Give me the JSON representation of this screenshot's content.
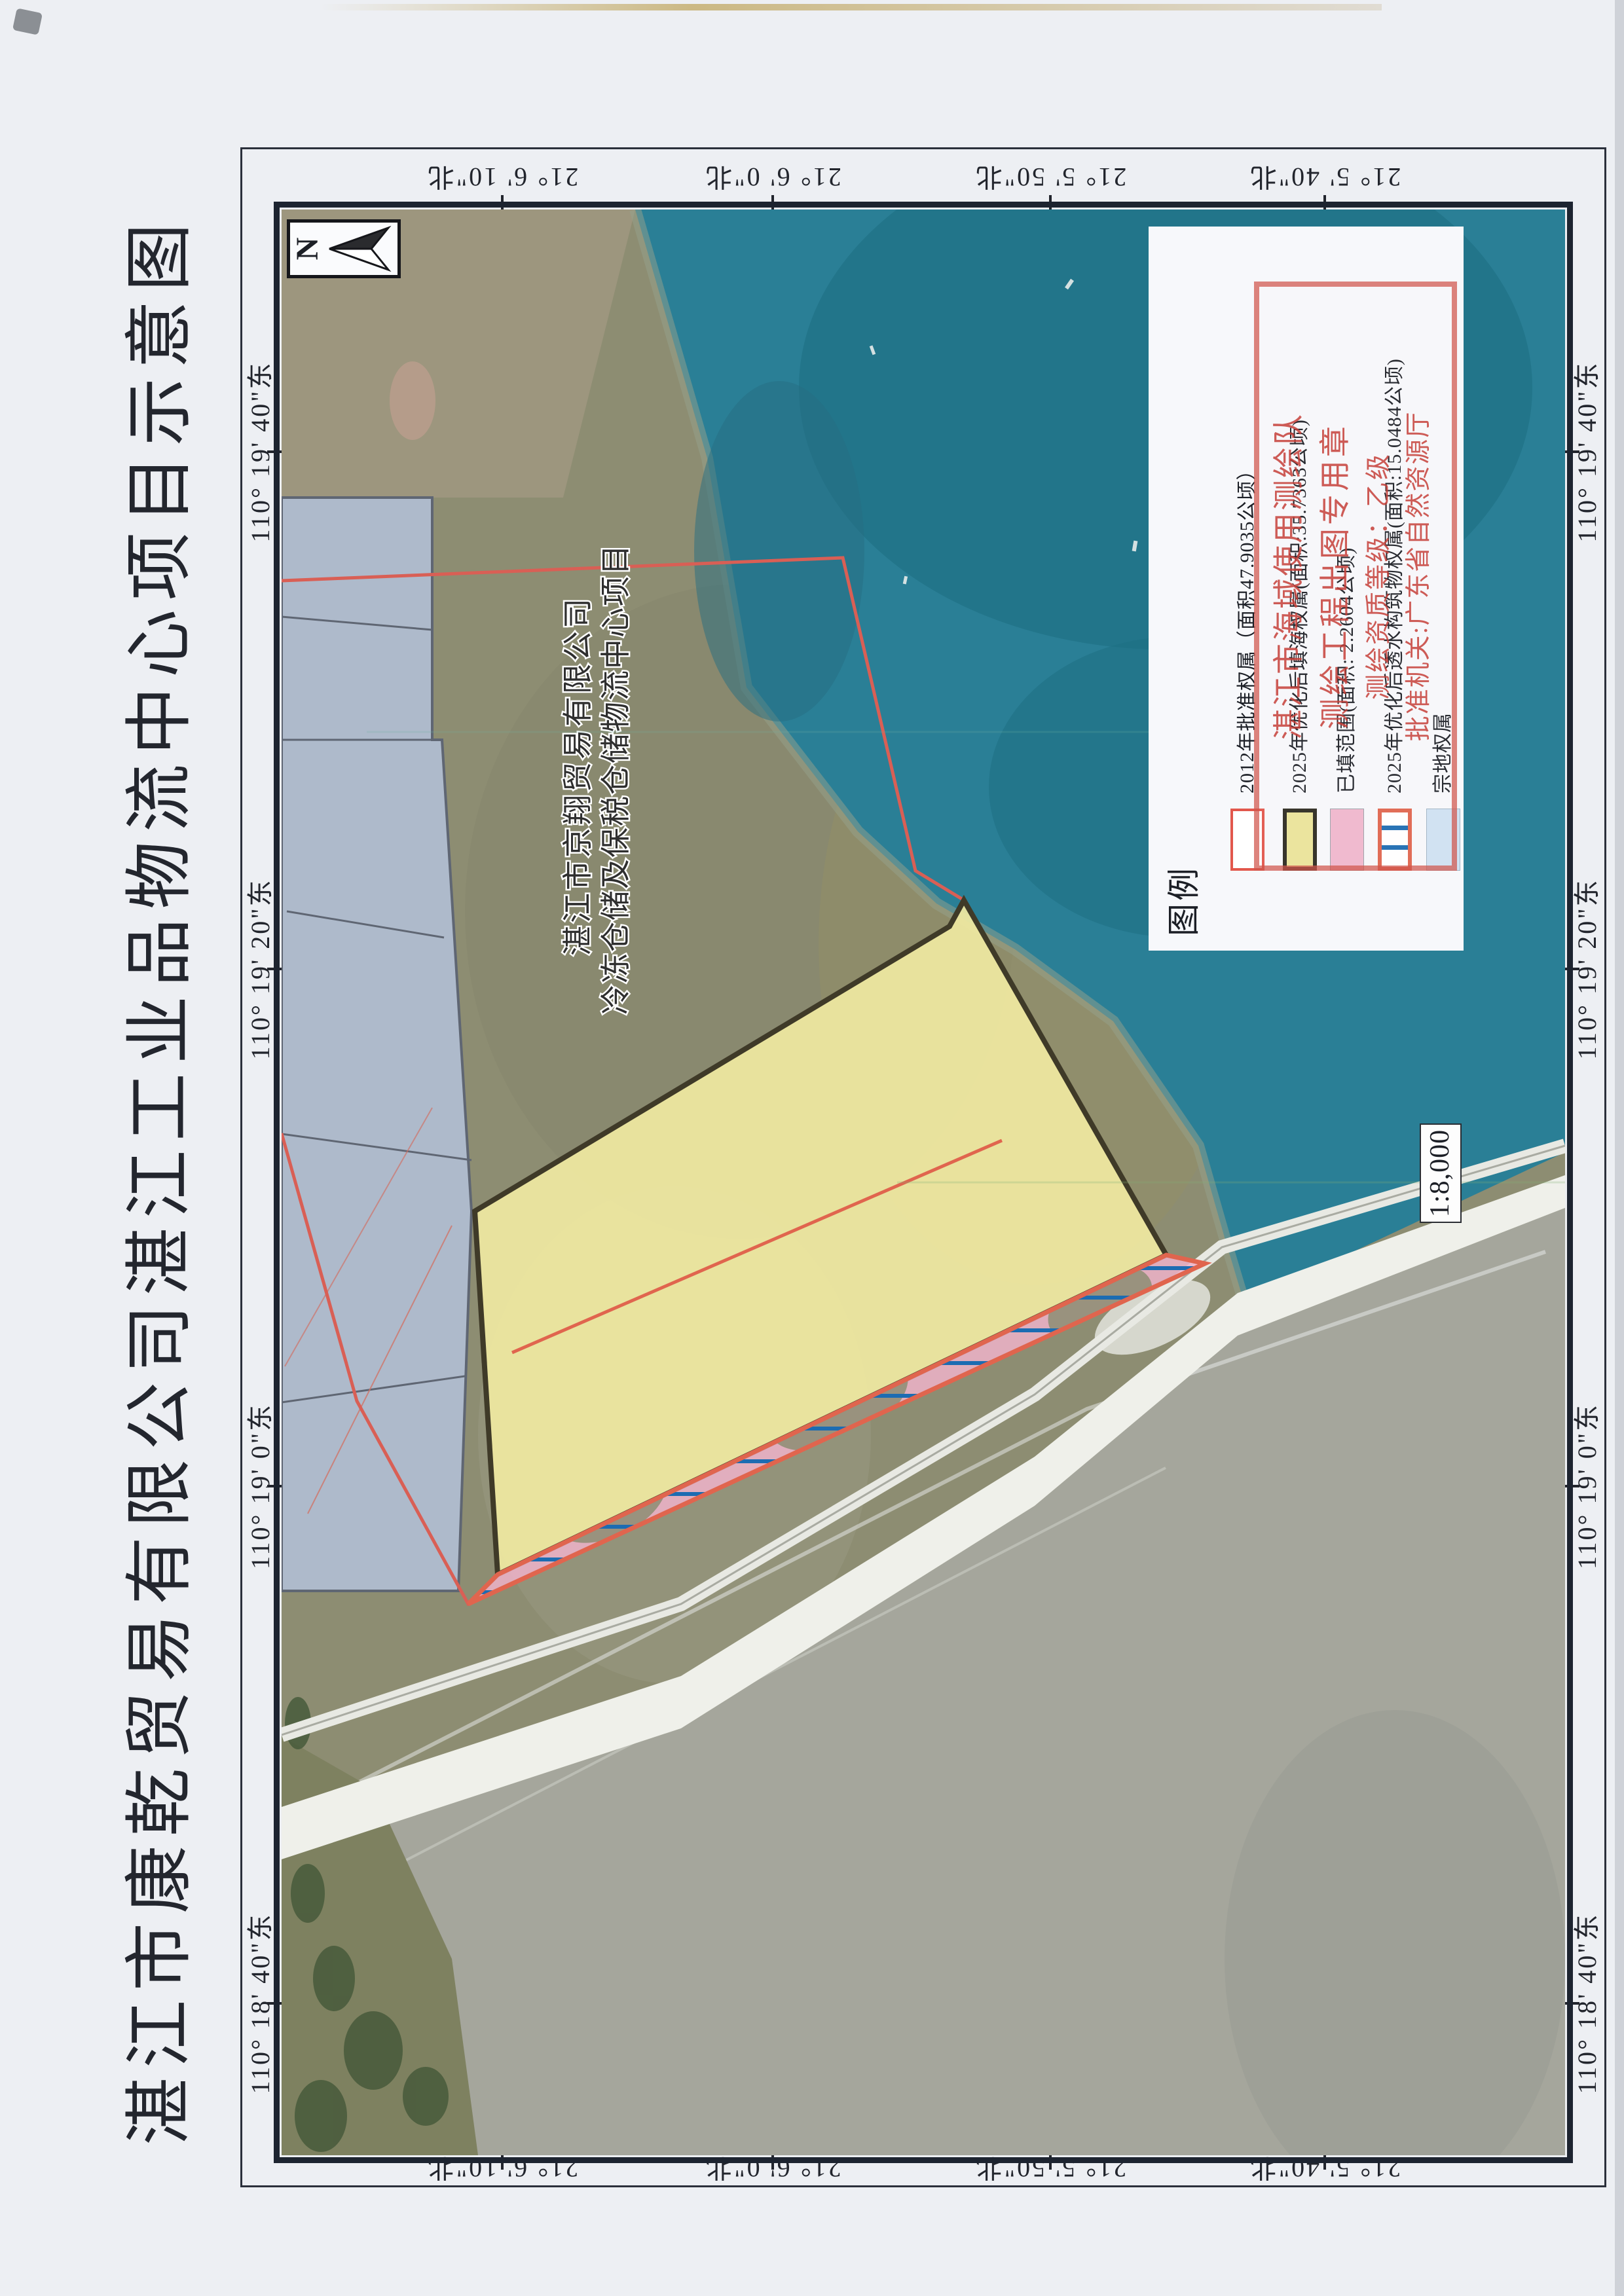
{
  "page": {
    "title": "湛江市康乾贸易有限公司湛江工业品物流中心项目示意图",
    "scale_text": "1:8,000",
    "north_label": "N"
  },
  "legend": {
    "title": "图例",
    "items": [
      {
        "key": "approved-2012",
        "label": "2012年批准权属（面积47.9035公顷）"
      },
      {
        "key": "reclaim-2025",
        "label": "2025年优化后填海权属(面积:35.7363公顷)"
      },
      {
        "key": "filled-range",
        "label": "已填范围(面积: 2.2604公顷)"
      },
      {
        "key": "permeable-2025",
        "label": "2025年优化后透水构筑物权属(面积:15.0484公顷)"
      },
      {
        "key": "parcel-rights",
        "label": "宗地权属"
      }
    ]
  },
  "stamp": {
    "lines": [
      "湛江市海域使用测绘队",
      "测绘工程出图专用章",
      "测绘资质等级：乙级",
      "批准机关:广东省自然资源厅"
    ]
  },
  "map_annotations": {
    "project_line1": "湛江市京翔贸易有限公司",
    "project_line2": "冷冻仓储及保税仓储物流中心项目"
  },
  "coordinates": {
    "lat": [
      {
        "label": "21° 6' 10\"北"
      },
      {
        "label": "21° 6' 0\"北"
      },
      {
        "label": "21° 5' 50\"北"
      },
      {
        "label": "21° 5' 40\"北"
      }
    ],
    "lon": [
      {
        "label": "110° 18' 40\"东"
      },
      {
        "label": "110° 19' 0\"东"
      },
      {
        "label": "110° 19' 20\"东"
      },
      {
        "label": "110° 19' 40\"东"
      }
    ]
  },
  "colors": {
    "frame": "#1d2430",
    "boundary_2012": "#d95f55",
    "reclaim_fill": "#efe8a0",
    "filled_pink": "#eeb3c9",
    "hatch_blue": "#1c6cb2",
    "sea_teal": "#2a7f96",
    "parcel_gray_blue": "#aebacb",
    "stamp_red": "#d0544b",
    "road_white": "#eff0ea"
  }
}
